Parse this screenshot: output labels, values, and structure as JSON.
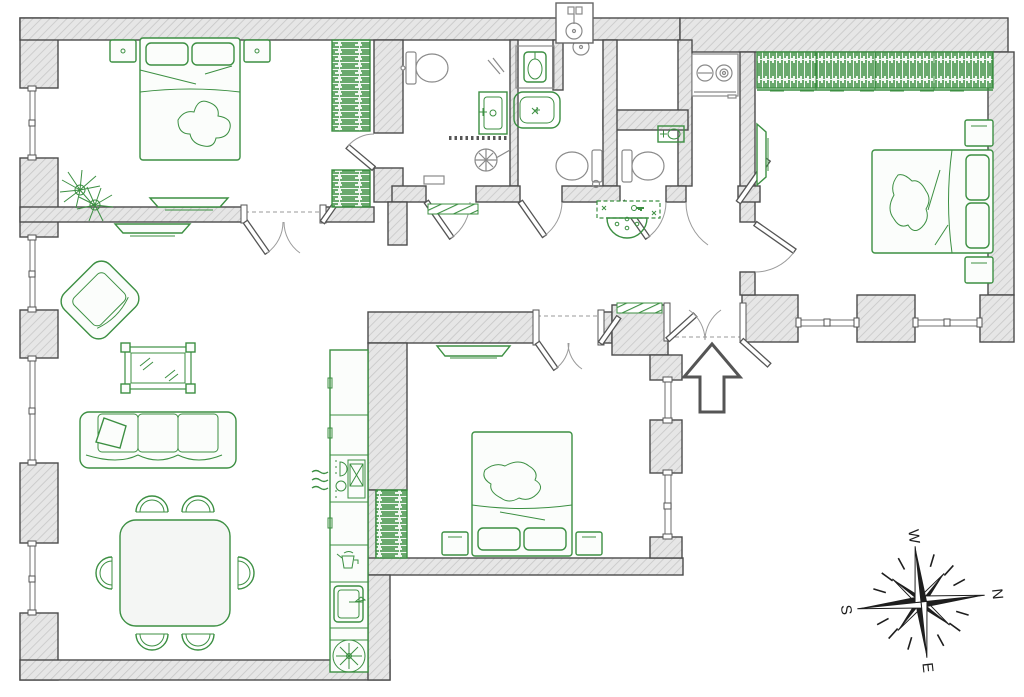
{
  "meta": {
    "type": "apartment-floor-plan",
    "width_px": 1024,
    "height_px": 697,
    "visible_text_only": [
      "W",
      "N",
      "S",
      "E"
    ]
  },
  "palette": {
    "furniture_green": "#3c8f42",
    "wall_fill": "#e6e6e6",
    "wall_hatch_line": "#c7c7c7",
    "wall_stroke": "#4b4b4b",
    "glass_gray": "#8f8f8f",
    "compass_black": "#1e1e1e"
  },
  "compass": {
    "rotation_deg": 84,
    "labels": {
      "n": "N",
      "e": "E",
      "s": "S",
      "w": "W"
    },
    "style": "8-point star rose with dashed tick rays"
  },
  "entrance": {
    "marker": "up-arrow",
    "door": "double-entry-door",
    "mat": "striped-doormat"
  },
  "rooms": [
    {
      "name": "bedroom-1",
      "position": "top-left",
      "furniture": [
        "double-bed",
        "pillow",
        "pillow",
        "nightstand-left",
        "nightstand-right",
        "potted-plant",
        "wall-tv",
        "wardrobe-upper",
        "wardrobe-lower",
        "ensuite-door"
      ]
    },
    {
      "name": "living-dining-room",
      "position": "left",
      "furniture": [
        "wall-tv",
        "armchair-rotated",
        "framed-mirror-table",
        "three-seat-sofa",
        "throw-pillow",
        "dining-table",
        "chair-x6",
        "french-double-doors"
      ]
    },
    {
      "name": "kitchen-run",
      "position": "center-left",
      "furniture": [
        "cabinet-run",
        "stove-with-oven",
        "steam-marks",
        "small-appliance",
        "kitchen-sink",
        "vent-fan",
        "tall-cabinet"
      ]
    },
    {
      "name": "bedroom-3",
      "position": "bottom-center",
      "furniture": [
        "double-bed",
        "pillow",
        "pillow",
        "nightstand-left",
        "nightstand-right",
        "wall-tv",
        "wardrobe",
        "double-doors",
        "two-windows"
      ]
    },
    {
      "name": "bathroom",
      "position": "top-center",
      "furniture": [
        "wall-hung-toilet",
        "vanity-basin",
        "mirror",
        "walk-in-shower",
        "shower-partition",
        "bench",
        "doormat"
      ]
    },
    {
      "name": "shower-room",
      "position": "top-center-2",
      "furniture": [
        "ceiling-shower",
        "washbasin-niche",
        "bathtub",
        "toilet",
        "floor-drain"
      ]
    },
    {
      "name": "wc",
      "position": "top-right-of-center",
      "furniture": [
        "toilet",
        "hand-basin"
      ]
    },
    {
      "name": "utility-room",
      "position": "top-right",
      "furniture": [
        "washing-machine"
      ]
    },
    {
      "name": "bedroom-2",
      "position": "right",
      "furniture": [
        "full-width-wardrobe",
        "wall-tv",
        "double-bed",
        "pillow",
        "pillow",
        "nightstand-upper",
        "nightstand-lower",
        "two-windows"
      ]
    },
    {
      "name": "hallway",
      "position": "center",
      "furniture": [
        "console-table",
        "semicircle-rug",
        "doormat-bathroom",
        "doormat-entrance",
        "ceiling-lamp-shaft"
      ]
    }
  ]
}
